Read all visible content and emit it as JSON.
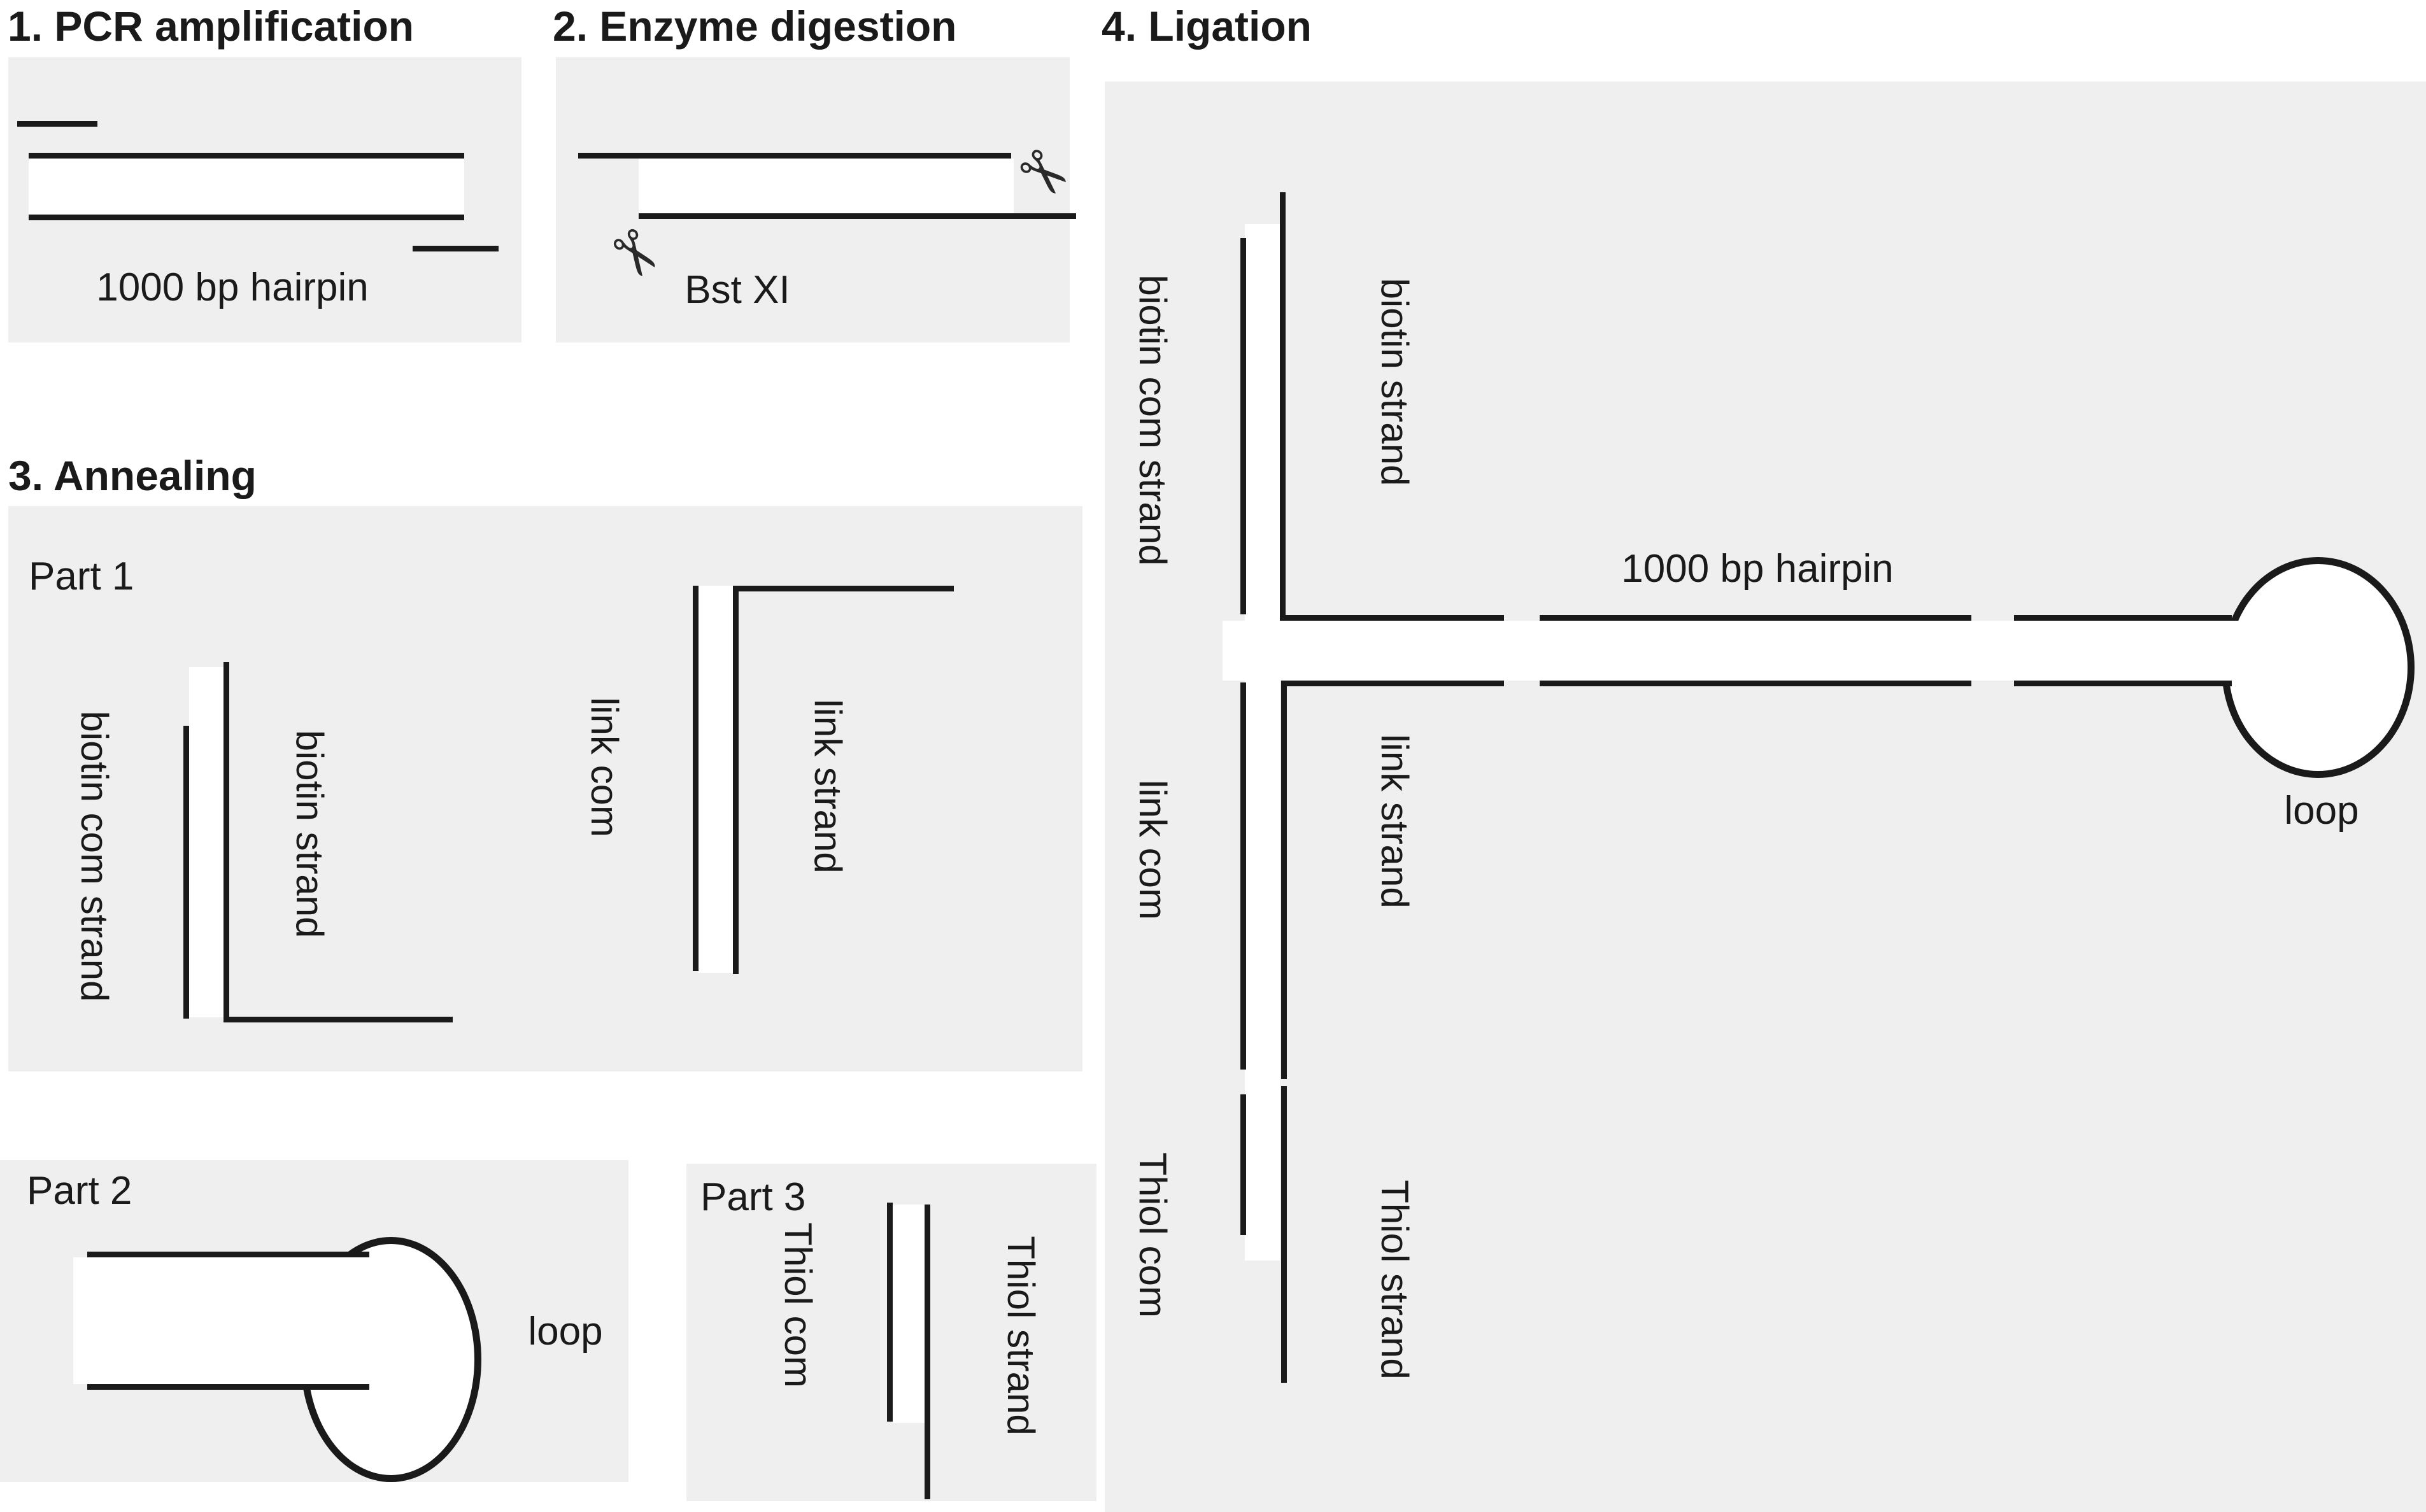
{
  "colors": {
    "canvas_bg": "#ffffff",
    "panel_bg": "#efefef",
    "line": "#1a1a1a",
    "text": "#1a1a1a"
  },
  "panel1": {
    "title": "1. PCR amplification",
    "caption": "1000 bp hairpin"
  },
  "panel2": {
    "title": "2. Enzyme digestion",
    "enzyme": "Bst XI",
    "scissors_glyph": "✂"
  },
  "panel3": {
    "title": "3. Annealing",
    "part1": {
      "label": "Part 1",
      "com_label": "biotin com strand",
      "strand_label": "biotin strand",
      "link_com_label": "link com",
      "link_strand_label": "link strand"
    },
    "part2": {
      "label": "Part 2",
      "loop_label": "loop"
    },
    "part3": {
      "label": "Part 3",
      "com_label": "Thiol com",
      "strand_label": "Thiol strand"
    }
  },
  "panel4": {
    "title": "4. Ligation",
    "biotin_com_label": "biotin com strand",
    "biotin_strand_label": "biotin strand",
    "hairpin_label": "1000 bp hairpin",
    "loop_label": "loop",
    "link_com_label": "link com",
    "link_strand_label": "link strand",
    "thiol_com_label": "Thiol com",
    "thiol_strand_label": "Thiol strand"
  }
}
